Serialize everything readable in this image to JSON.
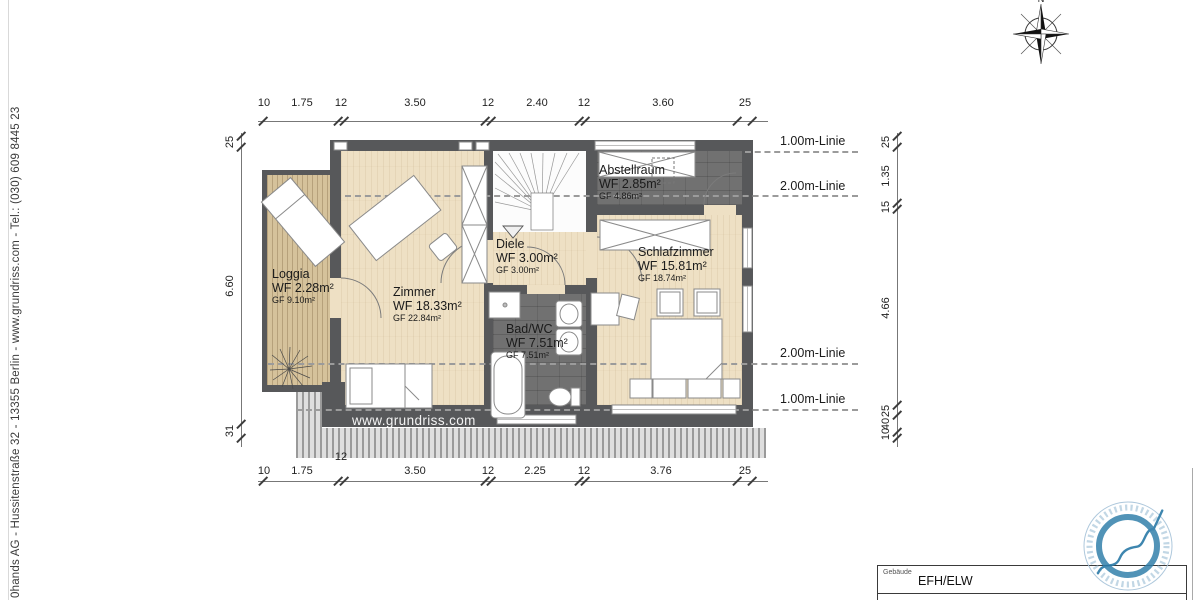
{
  "sidebar": {
    "text": "0hands AG - Hussitenstraße 32 - 13355 Berlin   -   www.grundriss.com   -   Tel.: (030) 609 8445 23"
  },
  "compass": {
    "label": "N"
  },
  "plan": {
    "watermark": "www.grundriss.com",
    "rooms": [
      {
        "name": "Loggia",
        "wf": "WF 2.28m²",
        "gf": "GF 9.10m²"
      },
      {
        "name": "Zimmer",
        "wf": "WF 18.33m²",
        "gf": "GF 22.84m²"
      },
      {
        "name": "Diele",
        "wf": "WF 3.00m²",
        "gf": "GF 3.00m²"
      },
      {
        "name": "Bad/WC",
        "wf": "WF 7.51m²",
        "gf": "GF 7.51m²"
      },
      {
        "name": "Abstellraum",
        "wf": "WF 2.85m²",
        "gf": "GF 4.86m²"
      },
      {
        "name": "Schlafzimmer",
        "wf": "WF 15.81m²",
        "gf": "GF 18.74m²"
      }
    ],
    "height_lines": [
      "1.00m-Linie",
      "2.00m-Linie",
      "2.00m-Linie",
      "1.00m-Linie"
    ]
  },
  "dimensions": {
    "top": [
      "10",
      "1.75",
      "12",
      "3.50",
      "12",
      "2.40",
      "12",
      "3.60",
      "25"
    ],
    "bottom": [
      "10",
      "1.75",
      "12",
      "3.50",
      "12",
      "2.25",
      "12",
      "3.76",
      "25"
    ],
    "left": [
      "25",
      "6.60",
      "31"
    ],
    "right": [
      "25",
      "1.35",
      "15",
      "4.66",
      "25",
      "40",
      "10"
    ]
  },
  "titleblock": {
    "field_label": "Gebäude",
    "field_value": "EFH/ELW"
  },
  "colors": {
    "wall": "#57585a",
    "wood_floor": "#eee0c4",
    "deck": "#d5c29b",
    "tile_floor": "#717171",
    "stamp_blue": "#2e7ca9"
  }
}
